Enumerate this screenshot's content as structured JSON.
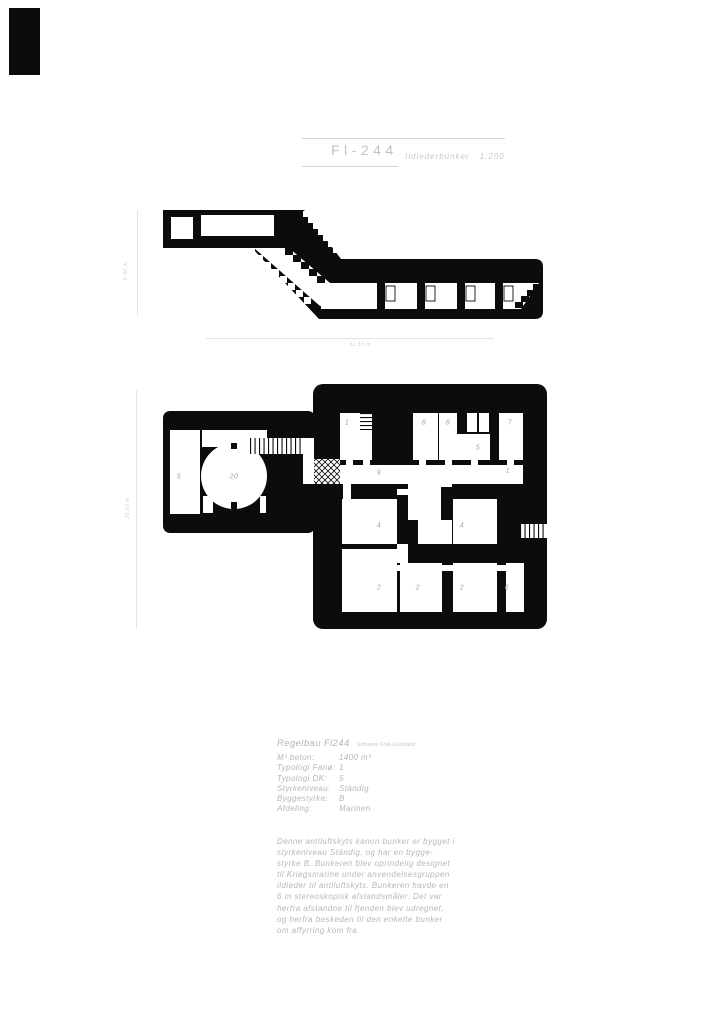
{
  "title_block": {
    "title": "Fl-244",
    "subtitle": "Ildlederbunker",
    "scale": "1:200"
  },
  "section": {
    "height_label": "8.30 m",
    "width_label": "31.50 m"
  },
  "plan": {
    "height_label": "20.00 m",
    "rooms": [
      {
        "label": "5"
      },
      {
        "label": "20"
      },
      {
        "label": "1"
      },
      {
        "label": "8"
      },
      {
        "label": "8"
      },
      {
        "label": "7"
      },
      {
        "label": "5"
      },
      {
        "label": "9"
      },
      {
        "label": "1"
      },
      {
        "label": "4"
      },
      {
        "label": "4"
      },
      {
        "label": "2"
      },
      {
        "label": "2"
      },
      {
        "label": "2"
      },
      {
        "label": "6"
      }
    ]
  },
  "info": {
    "heading": "Regelbau Fl244",
    "heading_note": "Schwere Flak-Leitstand",
    "specs": [
      {
        "label": "M³  beton:",
        "value": "1400 m³"
      },
      {
        "label": "Typologi Fanø:",
        "value": "1"
      },
      {
        "label": "Typologi DK:",
        "value": "5"
      },
      {
        "label": "Styrkeniveau:",
        "value": "Ständig"
      },
      {
        "label": "Byggestyrke:",
        "value": "B"
      },
      {
        "label": "Afdeling:",
        "value": "Marinen"
      }
    ],
    "paragraph_lines": [
      "Denne antiluftskyts kanon bunker er bygget i",
      "styrkeniveau Ständig, og har en bygge-",
      "styrke B. Bunkeren blev oprindelig designet",
      "til Kriegsmarine under anvendelsesgruppen",
      "ildleder til antiluftskyts. Bunkeren havde en",
      "6 m stereoskopisk afstandsmåler. Det var",
      "herfra afstandne til fjenden blev udregnet,",
      "og herfra beskeden til den enkelte bunker",
      "om affyrring kom fra."
    ]
  },
  "colors": {
    "ink": "#0c0c0a",
    "text_gray": "#b7b7b7",
    "line_gray": "#d6d6d6"
  }
}
